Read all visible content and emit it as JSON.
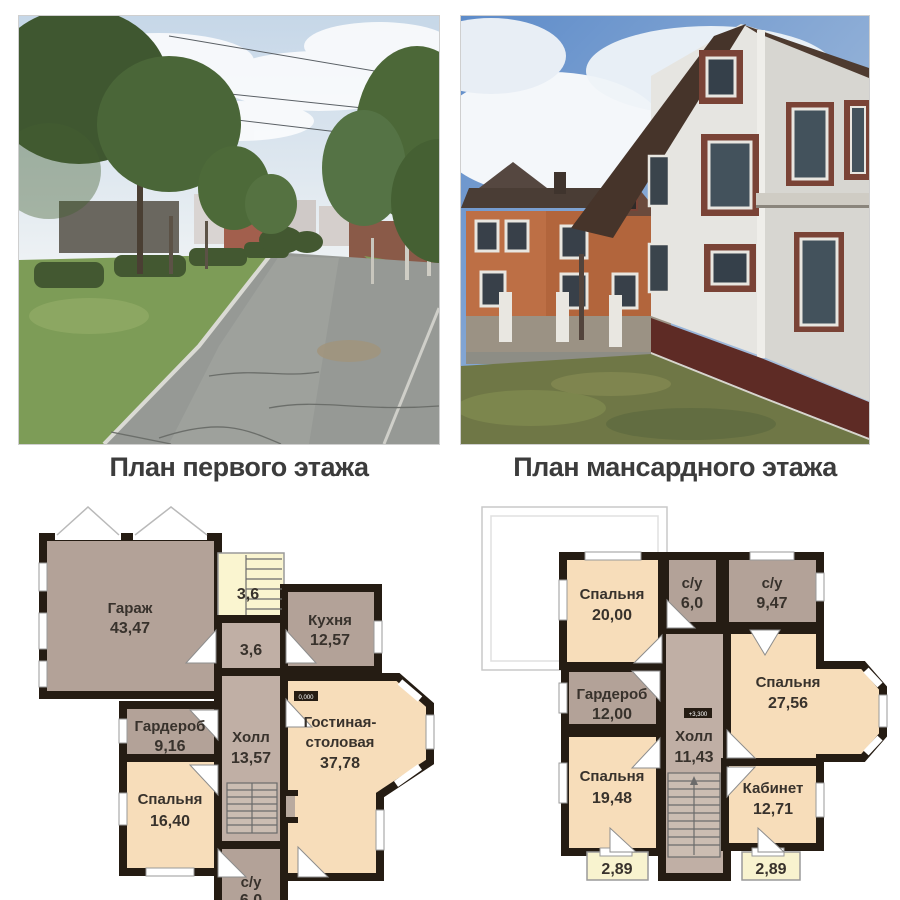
{
  "plans": {
    "first": {
      "title": "План первого этажа",
      "level_mark": "0,000",
      "rooms": {
        "garage": {
          "name": "Гараж",
          "area": "43,47"
        },
        "stairs": {
          "area": "3,6"
        },
        "kitchen": {
          "name": "Кухня",
          "area": "12,57"
        },
        "corridor": {
          "area": "3,6"
        },
        "wardrobe": {
          "name": "Гардероб",
          "area": "9,16"
        },
        "hall": {
          "name": "Холл",
          "area": "13,57"
        },
        "living": {
          "name1": "Гостиная-",
          "name2": "столовая",
          "area": "37,78"
        },
        "bedroom": {
          "name": "Спальня",
          "area": "16,40"
        },
        "wc": {
          "name": "с/у",
          "area": "6,0"
        }
      }
    },
    "attic": {
      "title": "План мансардного этажа",
      "level_mark": "+3,300",
      "rooms": {
        "bedroom1": {
          "name": "Спальня",
          "area": "20,00"
        },
        "wc1": {
          "name": "с/у",
          "area": "6,0"
        },
        "wc2": {
          "name": "с/у",
          "area": "9,47"
        },
        "wardrobe": {
          "name": "Гардероб",
          "area": "12,00"
        },
        "bedroom2": {
          "name": "Спальня",
          "area": "27,56"
        },
        "hall": {
          "name": "Холл",
          "area": "11,43"
        },
        "bedroom3": {
          "name": "Спальня",
          "area": "19,48"
        },
        "study": {
          "name": "Кабинет",
          "area": "12,71"
        },
        "balcony_left": {
          "area": "2,89"
        },
        "balcony_right": {
          "area": "2,89"
        }
      }
    }
  },
  "colors": {
    "wall": "#251c13",
    "room_peach": "#f7ddba",
    "room_taupe": "#b3a298",
    "room_hall": "#c0afa5",
    "room_yellow": "#faf5d0",
    "title_text": "#3c3c3c"
  }
}
